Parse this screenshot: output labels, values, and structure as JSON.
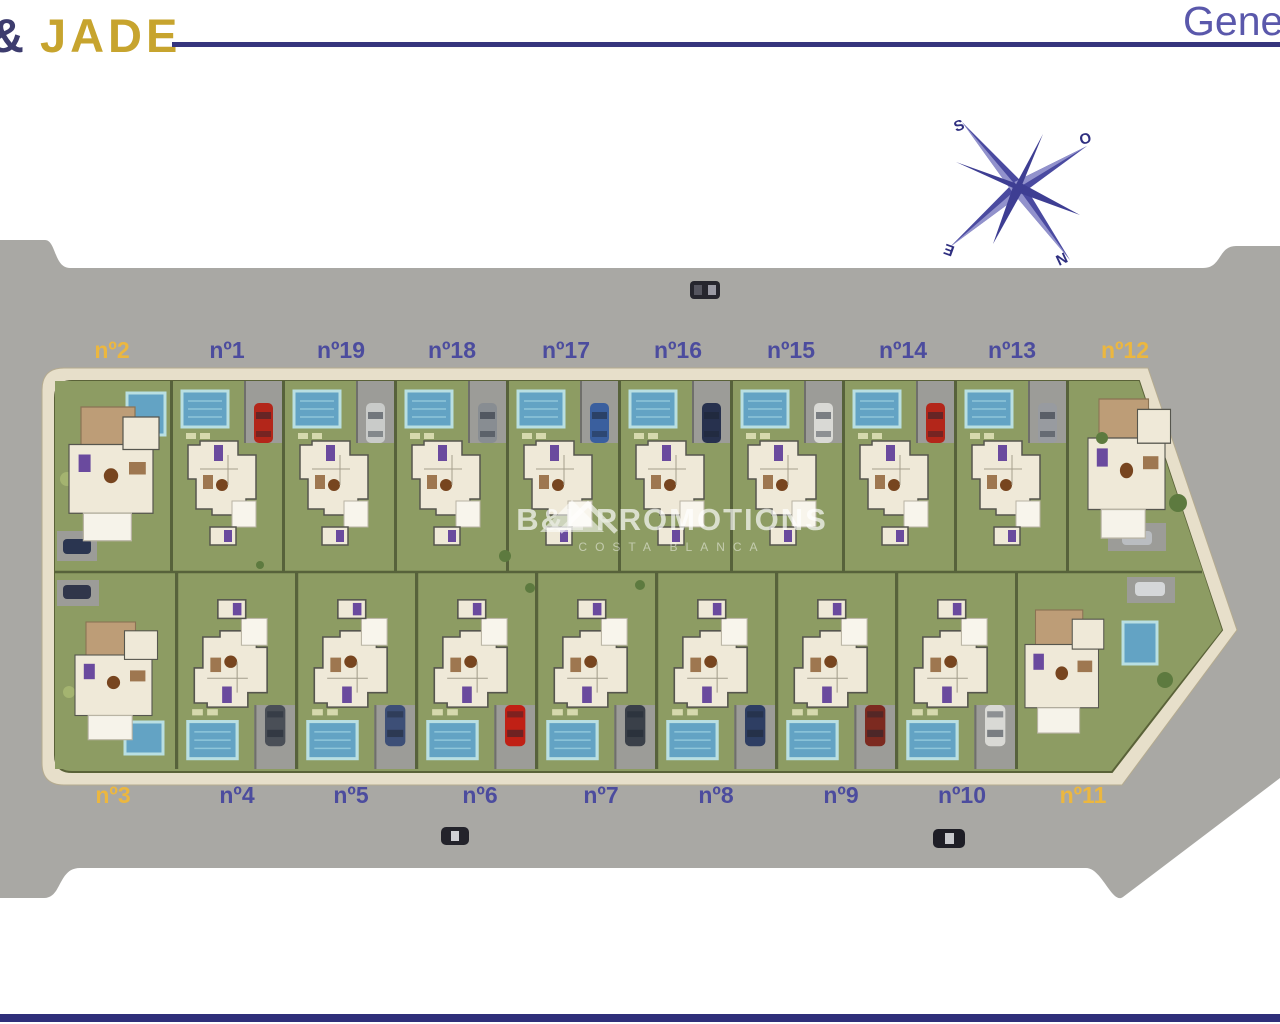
{
  "header": {
    "logo_symbol": "&",
    "logo_name": "JADE",
    "page_title_partial": "Gene"
  },
  "compass": {
    "south": "S",
    "west": "O",
    "east": "E",
    "north": "N"
  },
  "watermark": {
    "brand": "B&L PROMOTIONS",
    "subtitle": "COSTA BLANCA"
  },
  "colors": {
    "navy": "#36357d",
    "gold": "#c7a42e",
    "road": "#a9a8a4",
    "sidewalk": "#e7dfca",
    "lawn": "#8d9c63",
    "pool": "#63a3c4",
    "label_blue": "#4c4c9e",
    "label_yellow": "#ecb73f"
  },
  "plots": [
    {
      "label": "nº2",
      "label_color": "#ecb73f",
      "car": "#2a3550"
    },
    {
      "label": "nº1",
      "label_color": "#4c4c9e",
      "car": "#b3261a"
    },
    {
      "label": "nº19",
      "label_color": "#4c4c9e",
      "car": "#c9cbc9"
    },
    {
      "label": "nº18",
      "label_color": "#4c4c9e",
      "car": "#888d92"
    },
    {
      "label": "nº17",
      "label_color": "#4c4c9e",
      "car": "#3a5f9e"
    },
    {
      "label": "nº16",
      "label_color": "#4c4c9e",
      "car": "#27314e"
    },
    {
      "label": "nº15",
      "label_color": "#4c4c9e",
      "car": "#d9d9d5"
    },
    {
      "label": "nº14",
      "label_color": "#4c4c9e",
      "car": "#b3261a"
    },
    {
      "label": "nº13",
      "label_color": "#4c4c9e",
      "car": "#989ba0"
    },
    {
      "label": "nº12",
      "label_color": "#ecb73f",
      "car": "#babdc1"
    },
    {
      "label": "nº3",
      "label_color": "#ecb73f",
      "car": "#30364a"
    },
    {
      "label": "nº4",
      "label_color": "#4c4c9e",
      "car": "#4a4f57"
    },
    {
      "label": "nº5",
      "label_color": "#4c4c9e",
      "car": "#3d4f77"
    },
    {
      "label": "nº6",
      "label_color": "#4c4c9e",
      "car": "#c02015"
    },
    {
      "label": "nº7",
      "label_color": "#4c4c9e",
      "car": "#3a4049"
    },
    {
      "label": "nº8",
      "label_color": "#4c4c9e",
      "car": "#2e3e63"
    },
    {
      "label": "nº9",
      "label_color": "#4c4c9e",
      "car": "#7c2a20"
    },
    {
      "label": "nº10",
      "label_color": "#4c4c9e",
      "car": "#d9d9d5"
    },
    {
      "label": "nº11",
      "label_color": "#ecb73f",
      "car": "#d5d7d9"
    }
  ]
}
